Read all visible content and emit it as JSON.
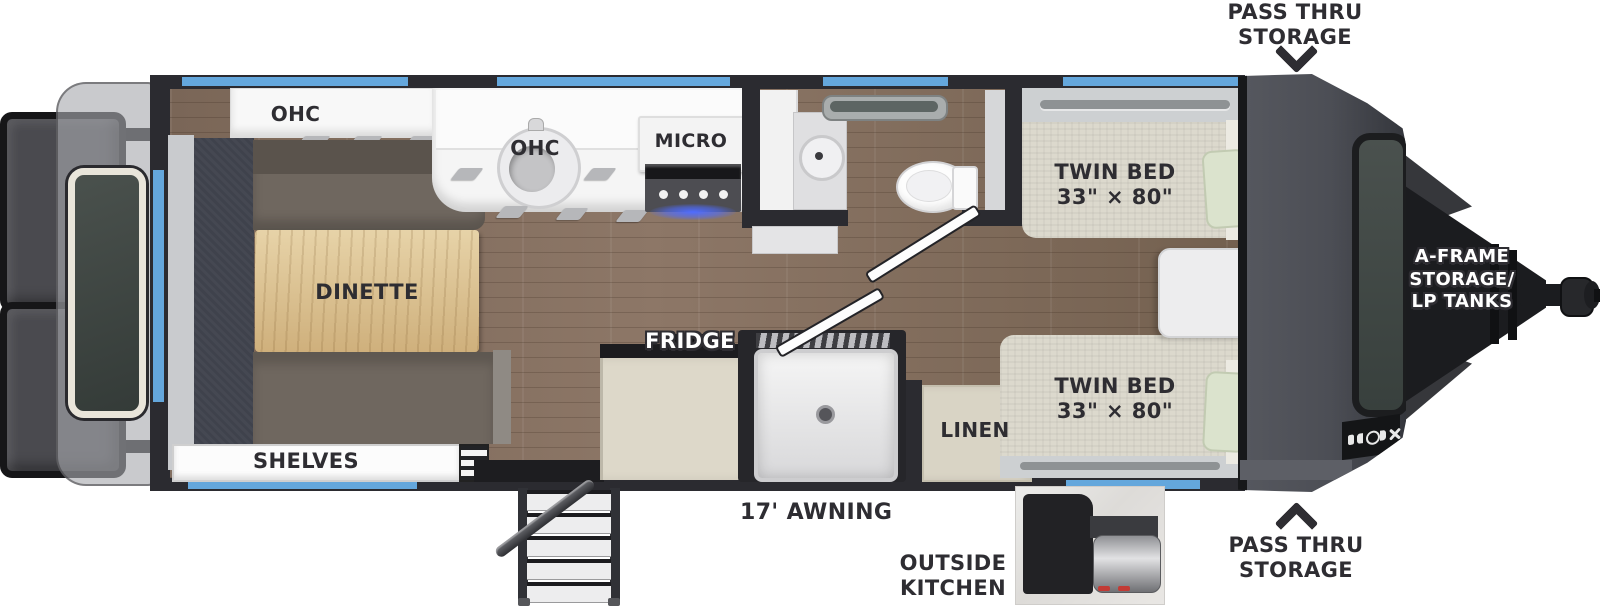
{
  "floorplan": {
    "exterior": {
      "pass_thru_storage_top": {
        "line1": "PASS THRU",
        "line2": "STORAGE"
      },
      "pass_thru_storage_bottom": {
        "line1": "PASS THRU",
        "line2": "STORAGE"
      },
      "a_frame_storage": {
        "line1": "A-FRAME",
        "line2": "STORAGE/",
        "line3": "LP TANKS"
      },
      "awning": "17' AWNING",
      "outside_kitchen": {
        "line1": "OUTSIDE",
        "line2": "KITCHEN"
      }
    },
    "interior": {
      "ohc_rear": "OHC",
      "ohc_kitchen": "OHC",
      "micro": "MICRO",
      "dinette": "DINETTE",
      "shelves": "SHELVES",
      "fridge": "FRIDGE",
      "linen": "LINEN",
      "twin_bed_top": {
        "line1": "TWIN BED",
        "line2": "33\" × 80\""
      },
      "twin_bed_bottom": {
        "line1": "TWIN BED",
        "line2": "33\" × 80\""
      }
    },
    "icons": {
      "pass_thru_arrow_top": "chevron-down",
      "pass_thru_arrow_bottom": "chevron-up"
    },
    "colors": {
      "accent_blue": "#64a7dc",
      "wall_dark": "#2b2b30",
      "label_dark": "#2e2d32",
      "floor_wood": "#85705f",
      "table_wood": "#d9b97f",
      "bench_fabric": "#6f675f",
      "mattress": "#dcd9cd",
      "pillow": "#dbe3cd",
      "cabinet_beige": "#d9d4c5",
      "front_cap_gray": "#4c4e55"
    }
  }
}
